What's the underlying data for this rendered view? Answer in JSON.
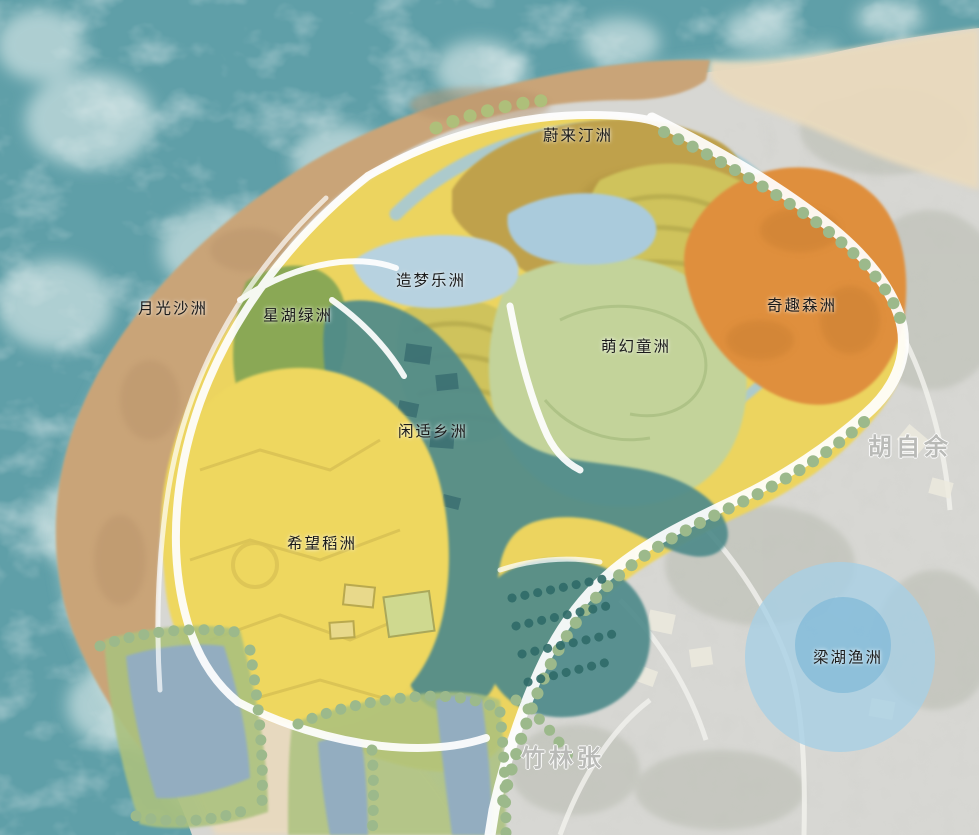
{
  "zones": [
    {
      "name": "weilai-tingzhou",
      "label": "蔚来汀洲",
      "color": "#bfa14b"
    },
    {
      "name": "yueguang-shazhou",
      "label": "月光沙洲",
      "color": "#c9a478"
    },
    {
      "name": "xinghu-lvzhou",
      "label": "星湖绿洲",
      "color": "#8aa855"
    },
    {
      "name": "zaomeng-lezhou",
      "label": "造梦乐洲",
      "color": "#b7d2e0"
    },
    {
      "name": "menghuan-tongzhou",
      "label": "萌幻童洲",
      "color": "#c3d39a"
    },
    {
      "name": "qiqu-senzhou",
      "label": "奇趣森洲",
      "color": "#df8f3e"
    },
    {
      "name": "xianshi-xiangzhou",
      "label": "闲适乡洲",
      "color": "#4f8a8a"
    },
    {
      "name": "xiwang-daozhou",
      "label": "希望稻洲",
      "color": "#eed75f"
    },
    {
      "name": "lianghu-yuzhou",
      "label": "梁湖渔洲",
      "color": "#a7d0e6"
    }
  ],
  "background_labels": [
    {
      "label": "胡自余"
    },
    {
      "label": "竹林张"
    }
  ],
  "colors": {
    "ocean": "#5f9fa8",
    "foam": "#eef6f4",
    "pale_sand": "#e9dabd",
    "park_yellow": "#ecd45e",
    "terrace": "#cfc35c",
    "river": "#a6c9d8",
    "pond_blue": "#93adc0",
    "photo_gray": "#d7d7d3",
    "road_white": "#ffffff",
    "tree_green": "#9cb98b",
    "orchard_teal": "#2f6b68",
    "bank_green": "#abc17e",
    "lake_inner": "#85bcd8"
  }
}
